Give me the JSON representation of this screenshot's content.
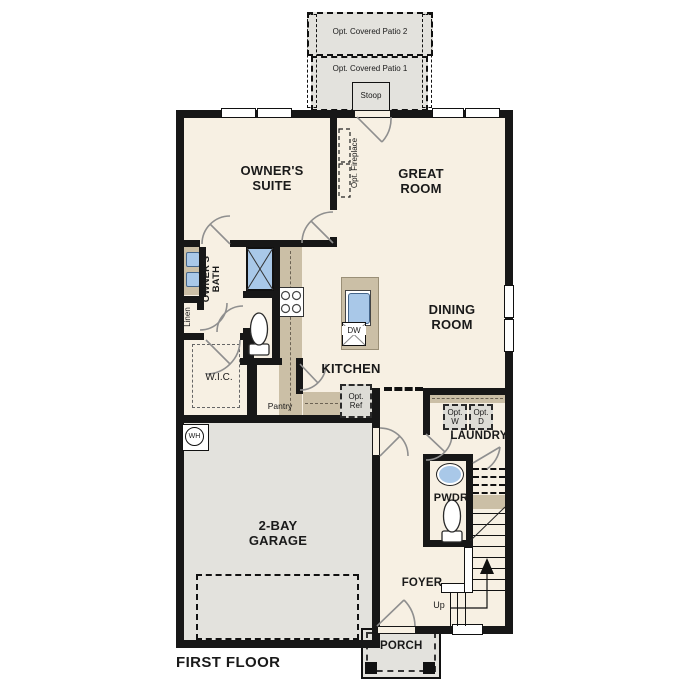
{
  "title": "FIRST FLOOR",
  "labels": {
    "patio2": "Opt. Covered Patio 2",
    "patio1": "Opt. Covered Patio 1",
    "stoop": "Stoop",
    "owners_suite": "OWNER'S SUITE",
    "great_room": "GREAT ROOM",
    "opt_fireplace": "Opt. Fireplace",
    "owners_bath": "OWNER'S BATH",
    "linen": "Linen",
    "wic": "W.I.C.",
    "kitchen": "KITCHEN",
    "pantry": "Pantry",
    "dining_room": "DINING ROOM",
    "opt_ref": "Opt. Ref",
    "opt_w": "Opt. W",
    "opt_d": "Opt. D",
    "laundry": "LAUNDRY",
    "pwdr": "PWDR",
    "garage": "2-BAY GARAGE",
    "foyer": "FOYER",
    "up": "Up",
    "porch": "PORCH",
    "dw": "DW",
    "wh": "WH"
  },
  "colors": {
    "floor": "#f7f0e3",
    "garage_gray": "#e3e2dd",
    "cabinet_tan": "#cbbfa6",
    "fixture_blue": "#a9c8e8",
    "wall": "#171717"
  }
}
